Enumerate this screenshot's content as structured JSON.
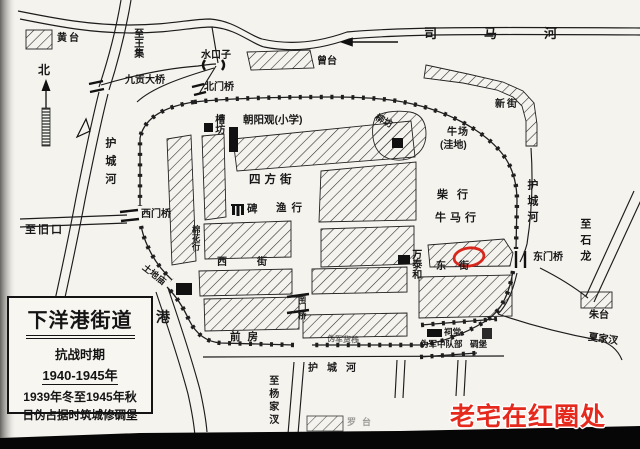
{
  "map": {
    "labels": {
      "huangtai": "黄台",
      "zhi_wangji": "至王集",
      "north": "北",
      "jiugong_bridge": "九贡大桥",
      "shuikouzi": "水口子",
      "beimen_bridge": "北门桥",
      "zengtai": "曾台",
      "sima_river": "司马河",
      "xinjie": "新街",
      "moat_left": "护城河",
      "moat_right": "护城河",
      "moat_bottom": "护城河",
      "chaoyang_school": "朝阳观(小学)",
      "caofang": "槽坊",
      "liufang": "柳坊",
      "niuchang": "牛场",
      "niuchang_note": "(洼地)",
      "sifang_street": "四方街",
      "stele": "碑",
      "yuhang": "渔行",
      "mianhua_hang": "棉花行",
      "ximen_bridge": "西门桥",
      "zhi_jiukou": "至旧口",
      "tudi_temple": "土地庙",
      "xi_street": "西街",
      "dong_street": "东街",
      "chai_hang": "柴行",
      "niuma_hang": "牛马行",
      "wantaihe": "万泰和",
      "dongmen_bridge": "东门桥",
      "zhi_shilong": "至石龙",
      "nanmen_bridge": "南门桥",
      "qianfang": "前房",
      "gang": "港",
      "zhi_yangjiacha": "至杨家汊",
      "weijun_huozhan": "伪军货栈",
      "citang": "祠堂",
      "weijun_zhongduibu": "伪军中队部",
      "diaobao": "碉堡",
      "zhutai": "朱台",
      "xiajiacha": "夏家汊",
      "luotai": "罗台"
    },
    "title_box": {
      "title": "下洋港街道",
      "period": "抗战时期",
      "years": "1940-1945年",
      "line3": "1939年冬至1945年秋",
      "line4": "日伪占据时筑城修碉堡"
    },
    "annotation": {
      "text": "老宅在红圈处",
      "color": "#e5291d"
    },
    "red_circle_color": "#d9261c",
    "paper_color": "#f5f3ee"
  }
}
